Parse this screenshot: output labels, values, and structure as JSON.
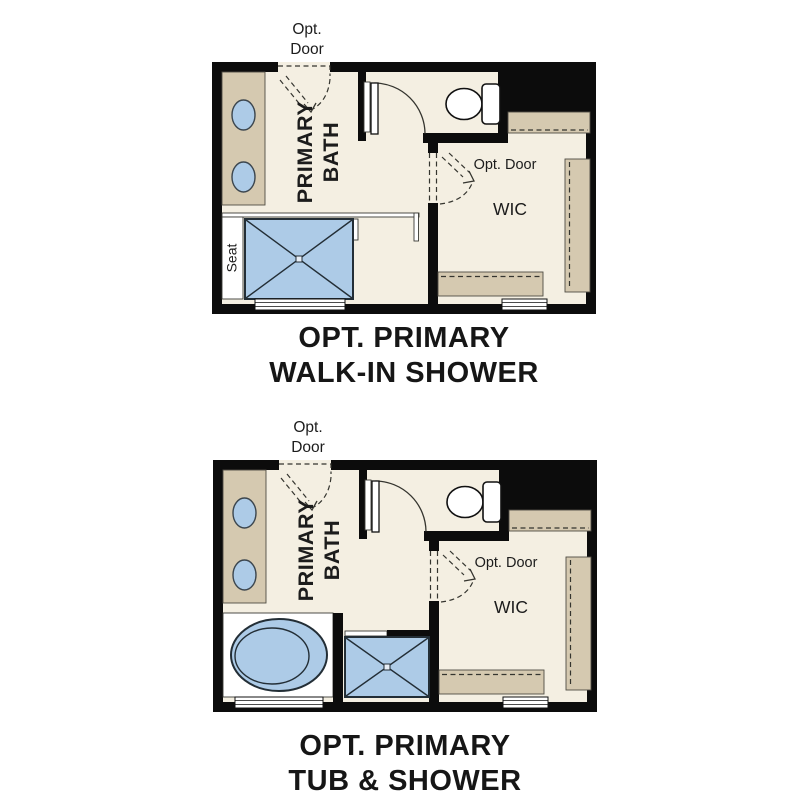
{
  "page": {
    "background": "#ffffff",
    "content": "Two optional primary bathroom floor plan configurations"
  },
  "colors": {
    "wall": "#0c0c0c",
    "floor": "#f4efe2",
    "cabinet_tan": "#d5c9b0",
    "fixture_blue": "#adcbe7",
    "line": "#35352f",
    "white": "#ffffff",
    "text": "#161616"
  },
  "plans": [
    {
      "id": "opt-primary-walk-in-shower",
      "labels": {
        "opt_door_top_line1": "Opt.",
        "opt_door_top_line2": "Door",
        "room_line1": "PRIMARY",
        "room_line2": "BATH",
        "wic_opt_door": "Opt. Door",
        "wic": "WIC",
        "seat": "Seat"
      },
      "caption_line1": "OPT. PRIMARY",
      "caption_line2": "WALK-IN SHOWER"
    },
    {
      "id": "opt-primary-tub-and-shower",
      "labels": {
        "opt_door_top_line1": "Opt.",
        "opt_door_top_line2": "Door",
        "room_line1": "PRIMARY",
        "room_line2": "BATH",
        "wic_opt_door": "Opt. Door",
        "wic": "WIC"
      },
      "caption_line1": "OPT. PRIMARY",
      "caption_line2": "TUB & SHOWER"
    }
  ]
}
